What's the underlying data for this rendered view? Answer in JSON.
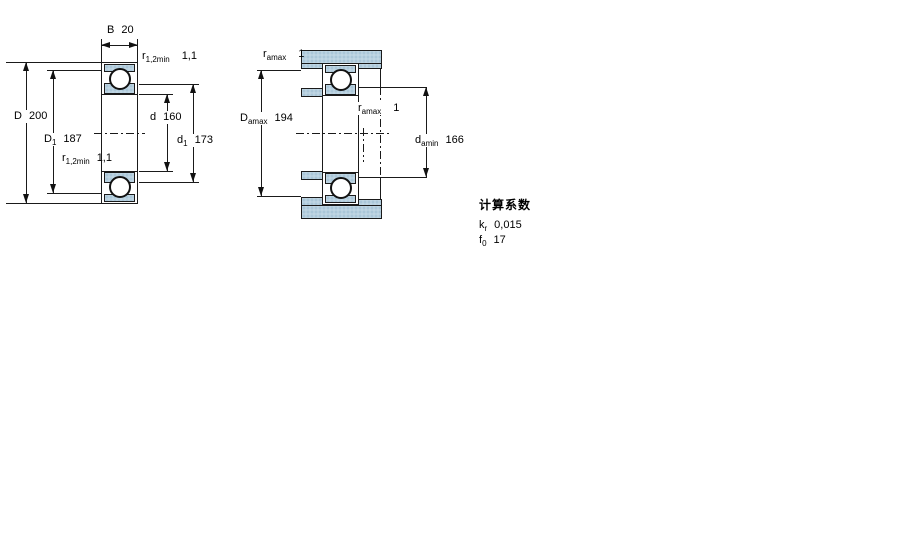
{
  "left_view": {
    "name": "bearing boundary dimensions section view",
    "labels": {
      "width": {
        "main": "B",
        "value": "20"
      },
      "outer_diameter": {
        "main": "D",
        "value": "200"
      },
      "recess_diameter_outer": {
        "main": "D",
        "sub": "1",
        "value": "187"
      },
      "fillet_top": {
        "main": "r",
        "sub": "1,2min",
        "value": "1,1"
      },
      "fillet_bottom": {
        "main": "r",
        "sub": "1,2min",
        "value": "1,1"
      },
      "bore_diameter": {
        "main": "d",
        "value": "160"
      },
      "recess_diameter_inner": {
        "main": "d",
        "sub": "1",
        "value": "173"
      }
    }
  },
  "right_view": {
    "name": "abutment and fillet dimensions view",
    "labels": {
      "fillet_housing": {
        "main": "r",
        "sub": "amax",
        "value": "1"
      },
      "housing_shoulder": {
        "main": "D",
        "sub": "amax",
        "value": "194"
      },
      "fillet_shaft": {
        "main": "r",
        "sub": "amax",
        "value": "1"
      },
      "shaft_shoulder": {
        "main": "d",
        "sub": "amin",
        "value": "166"
      }
    }
  },
  "factors": {
    "heading": "计算系数",
    "rows": [
      {
        "main": "k",
        "sub": "r",
        "value": "0,015"
      },
      {
        "main": "f",
        "sub": "0",
        "value": "17"
      }
    ]
  },
  "colors": {
    "section_fill": "#b7d0df",
    "section_dot": "#84aac3",
    "line": "#1a1a1a"
  }
}
